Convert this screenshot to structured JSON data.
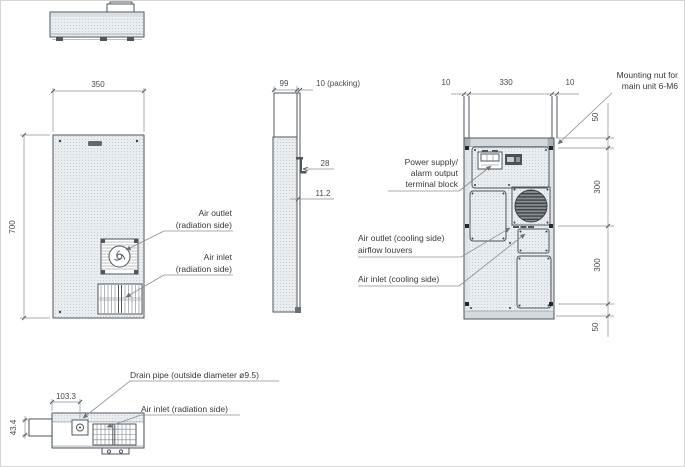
{
  "front": {
    "dim_width": "350",
    "dim_height": "700",
    "air_outlet_line1": "Air outlet",
    "air_outlet_line2": "(radiation side)",
    "air_inlet_line1": "Air inlet",
    "air_inlet_line2": "(radiation side)"
  },
  "side": {
    "dim_depth": "99",
    "dim_packing": "10 (packing)",
    "dim_bracket": "28",
    "dim_offset": "11.2"
  },
  "rear": {
    "dim_left": "10",
    "dim_center": "330",
    "dim_right": "10",
    "dim_top": "50",
    "dim_upper": "300",
    "dim_lower": "300",
    "dim_bottom": "50",
    "mounting_line1": "Mounting nut for",
    "mounting_line2": "main unit 6-M6",
    "power_line1": "Power supply/",
    "power_line2": "alarm output",
    "power_line3": "terminal block",
    "outlet_line1": "Air outlet (cooling side)",
    "outlet_line2": "airflow louvers",
    "inlet": "Air inlet (cooling side)"
  },
  "bottom": {
    "dim_x": "103.3",
    "dim_y": "43.4",
    "drain": "Drain pipe (outside diameter ø9.5)",
    "inlet": "Air inlet (radiation side)"
  },
  "colors": {
    "outline": "#4f565c",
    "dim_line": "#8a9094",
    "text": "#454b50",
    "panel_fill": "#e9edf0",
    "speckle": "#c5cfd6",
    "fan_dark": "#3e4347",
    "fan_mid": "#878e93"
  }
}
